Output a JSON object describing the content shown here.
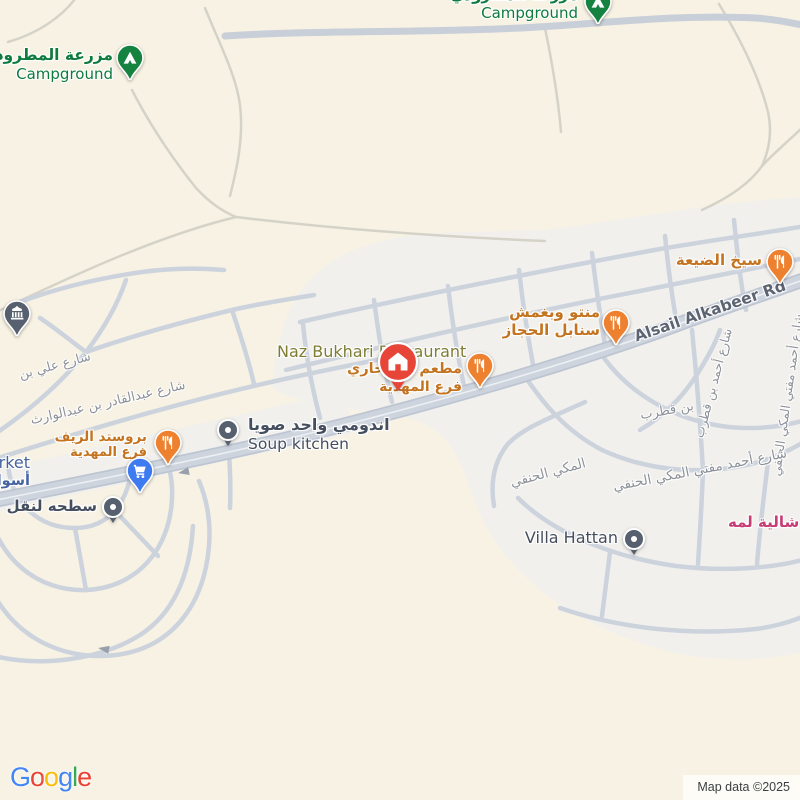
{
  "colors": {
    "bg": "#f7f2e3",
    "urban": "#f1f0ec",
    "road_major": "#ced4de",
    "road_major_casing": "#bdc5d2",
    "road_minor": "#ccd3dd",
    "road_faint": "#d5d3c8",
    "pin_orange": "#ee8130",
    "pin_green": "#15823f",
    "pin_blue": "#3e7bf0",
    "pin_gray": "#56606e",
    "pin_red": "#e74538",
    "label_green": "#0e7b3d",
    "label_orange": "#c4731f",
    "label_gray": "#454e5e",
    "label_blue": "#44639f",
    "label_pink": "#c73c74",
    "label_olive": "#7e7d33",
    "street_label": "#8d9199",
    "road_label": "#5d6471"
  },
  "attribution": "Map data ©2025",
  "logo_letters": [
    {
      "ch": "G",
      "color": "#4285F4"
    },
    {
      "ch": "o",
      "color": "#EA4335"
    },
    {
      "ch": "o",
      "color": "#FBBC05"
    },
    {
      "ch": "g",
      "color": "#4285F4"
    },
    {
      "ch": "l",
      "color": "#34A853"
    },
    {
      "ch": "e",
      "color": "#EA4335"
    }
  ],
  "pois": [
    {
      "id": "campground-matroudi",
      "pin": "campground",
      "px": 130,
      "py": 58,
      "label": {
        "lx": 113,
        "ly": 46,
        "align": "right",
        "lines": [
          {
            "text": "مزرعة المطرودي",
            "size": 15.5,
            "color": "#0e7b3d",
            "weight": 700
          },
          {
            "text": "Campground",
            "size": 15,
            "color": "#0e7b3d",
            "weight": 400
          }
        ]
      }
    },
    {
      "id": "campground-north",
      "pin": "campground",
      "px": 598,
      "py": 2,
      "label": {
        "lx": 578,
        "ly": -14,
        "align": "right",
        "lines": [
          {
            "text": "مزرعة المطرودي",
            "size": 15,
            "color": "#0e7b3d",
            "weight": 700
          },
          {
            "text": "Campground",
            "size": 15,
            "color": "#0e7b3d",
            "weight": 400
          }
        ]
      }
    },
    {
      "id": "seekh-aldayaa",
      "pin": "restaurant",
      "px": 780,
      "py": 262,
      "label": {
        "lx": 762,
        "ly": 251,
        "align": "right",
        "lines": [
          {
            "text": "سيخ الضيعة",
            "size": 15,
            "color": "#c4731f",
            "weight": 700
          }
        ]
      }
    },
    {
      "id": "manto-wabaghmash-sanabil-alhijaz",
      "pin": "restaurant",
      "px": 616,
      "py": 323,
      "label": {
        "lx": 600,
        "ly": 303,
        "align": "right",
        "lines": [
          {
            "text": "منتو وبغمش",
            "size": 15,
            "color": "#c4731f",
            "weight": 700
          },
          {
            "text": "سنابل الحجاز",
            "size": 15,
            "color": "#c4731f",
            "weight": 700
          }
        ]
      }
    },
    {
      "id": "naz-bukhari-restaurant",
      "pin": "home",
      "px": 398,
      "py": 362,
      "label": {
        "lx": 277,
        "ly": 342,
        "align": "left",
        "lines": [
          {
            "text": "Naz Bukhari Restaurant",
            "size": 16,
            "color": "#7e7d33",
            "weight": 400
          }
        ]
      }
    },
    {
      "id": "matam-naz-bukhari",
      "pin": "restaurant",
      "px": 480,
      "py": 366,
      "label": {
        "lx": 462,
        "ly": 361,
        "align": "right",
        "lines": [
          {
            "text": "مطعم ناز بخاري",
            "size": 14.5,
            "color": "#c4731f",
            "weight": 700
          },
          {
            "text": "فرع المهدية",
            "size": 14,
            "color": "#c4731f",
            "weight": 700
          }
        ]
      }
    },
    {
      "id": "broasted-alreef",
      "pin": "restaurant",
      "px": 168,
      "py": 443,
      "label": {
        "lx": 147,
        "ly": 429,
        "align": "right",
        "lines": [
          {
            "text": "بروستد الريف",
            "size": 13.5,
            "color": "#c4731f",
            "weight": 700
          },
          {
            "text": "فرع المهدية",
            "size": 13,
            "color": "#c4731f",
            "weight": 700
          }
        ]
      }
    },
    {
      "id": "supermarket",
      "pin": "cart",
      "px": 140,
      "py": 471,
      "label": {
        "lx": 30,
        "ly": 453,
        "align": "right",
        "lines": [
          {
            "text": "Supermarket",
            "size": 16,
            "color": "#44639f",
            "weight": 400
          },
          {
            "text": "أسواق",
            "size": 14.5,
            "color": "#44639f",
            "weight": 700
          }
        ]
      }
    },
    {
      "id": "soup-kitchen",
      "pin": "dot",
      "px": 228,
      "py": 430,
      "label": {
        "lx": 248,
        "ly": 415,
        "align": "left",
        "lines": [
          {
            "text": "اندومي واحد صويا",
            "size": 16,
            "color": "#454e5e",
            "weight": 700
          },
          {
            "text": "Soup kitchen",
            "size": 15.5,
            "color": "#454e5e",
            "weight": 400
          }
        ]
      }
    },
    {
      "id": "satha-transport",
      "pin": "dot",
      "px": 113,
      "py": 507,
      "label": {
        "lx": 97,
        "ly": 497,
        "align": "right",
        "lines": [
          {
            "text": "سطحه لنقل",
            "size": 15,
            "color": "#454e5e",
            "weight": 700
          }
        ]
      }
    },
    {
      "id": "building-poi",
      "pin": "building",
      "px": 17,
      "py": 314
    },
    {
      "id": "villa-hattan",
      "pin": "dot",
      "px": 634,
      "py": 539,
      "label": {
        "lx": 618,
        "ly": 528,
        "align": "right",
        "lines": [
          {
            "text": "Villa Hattan",
            "size": 16,
            "color": "#454e5e",
            "weight": 400
          }
        ]
      }
    },
    {
      "id": "chalet-lamah",
      "pin": "none",
      "px": 0,
      "py": 0,
      "label": {
        "lx": 728,
        "ly": 513,
        "align": "left",
        "lines": [
          {
            "text": "شالية لمه",
            "size": 15,
            "color": "#c73c74",
            "weight": 700
          }
        ]
      }
    }
  ],
  "streets": [
    {
      "id": "ali-bin-st",
      "text": "شارع علي بن",
      "x": 55,
      "y": 366,
      "rot": -15,
      "size": 13,
      "color": "#8d9199"
    },
    {
      "id": "abdulqadir-bin-abdulwarith-st",
      "text": "شارع عبدالقادر بن عبدالوارث",
      "x": 108,
      "y": 403,
      "rot": -13,
      "size": 13,
      "color": "#8d9199"
    },
    {
      "id": "alsail-alkabeer-rd",
      "text": "Alsail Alkabeer Rd",
      "x": 710,
      "y": 311,
      "rot": -19,
      "size": 15.5,
      "color": "#5d6471",
      "weight": 700
    },
    {
      "id": "ahmad-bin-qutrub-st",
      "text": "شارع أحمد بن قطرب",
      "x": 713,
      "y": 383,
      "rot": -75,
      "size": 12.5,
      "color": "#8d9199"
    },
    {
      "id": "bin-qutrub-st",
      "text": "بن قطرب",
      "x": 667,
      "y": 411,
      "rot": -10,
      "size": 13,
      "color": "#8d9199"
    },
    {
      "id": "ahmad-mufti-almakki-st-right",
      "text": "شارع أحمد مفتي المكي الحنفي",
      "x": 787,
      "y": 395,
      "rot": -82,
      "size": 12.5,
      "color": "#8d9199"
    },
    {
      "id": "almakki-alhanafi-st",
      "text": "المكي الحنفي",
      "x": 548,
      "y": 473,
      "rot": -15,
      "size": 13.5,
      "color": "#8d9199"
    },
    {
      "id": "ahmad-mufti-almakki-st-curve",
      "text": "شارع أحمد مفتي المكي الحنفي",
      "x": 700,
      "y": 470,
      "rot": -11,
      "size": 13.5,
      "color": "#8d9199"
    }
  ]
}
